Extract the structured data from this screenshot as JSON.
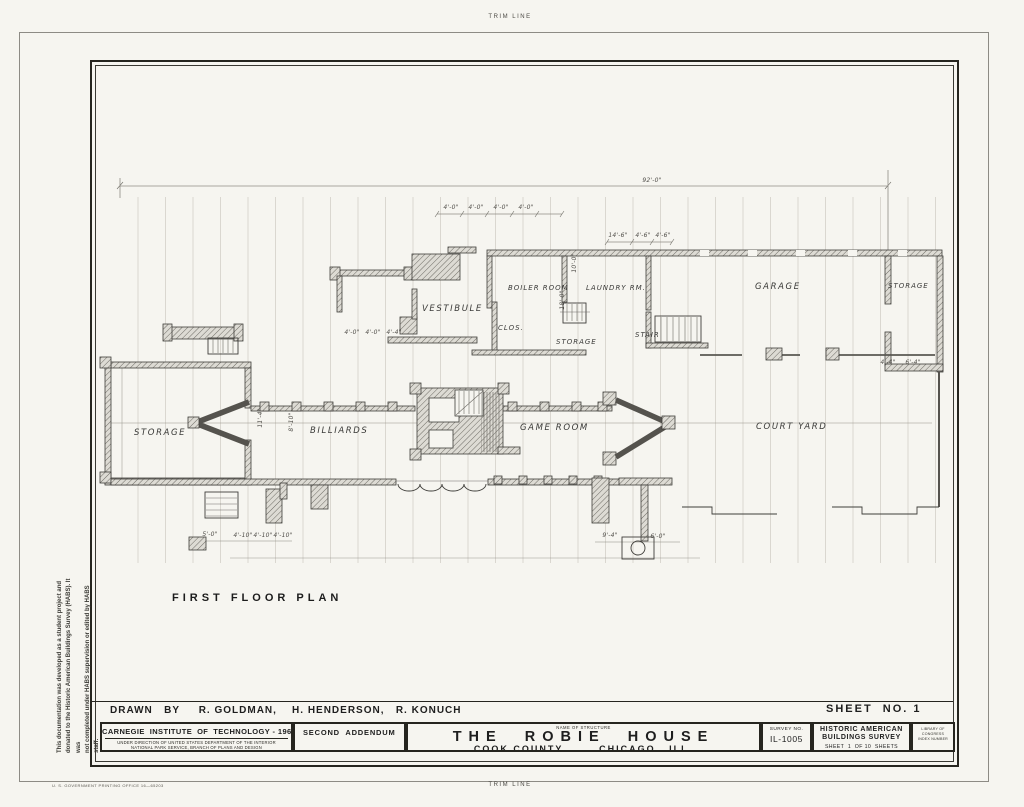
{
  "colors": {
    "paper": "#f6f5f0",
    "ink": "#26251f",
    "wall": "#55534e",
    "grid": "#c6c3ba"
  },
  "sheet": {
    "trim_line_top": "TRIM LINE",
    "trim_line_bottom": "TRIM LINE",
    "gpo_imprint": "U. S. GOVERNMENT PRINTING OFFICE      16—65203",
    "disclaimer_line1": "This documentation was developed as a student project and",
    "disclaimer_line2": "donated to the Historic American Buildings Survey (HABS). It was",
    "disclaimer_line3": "not completed under HABS supervision or edited by HABS staff."
  },
  "plan": {
    "title": "FIRST  FLOOR  PLAN",
    "rooms": [
      {
        "id": "storage-west",
        "label": "STORAGE"
      },
      {
        "id": "billiards",
        "label": "BILLIARDS"
      },
      {
        "id": "game-room",
        "label": "GAME ROOM"
      },
      {
        "id": "court-yard",
        "label": "COURT  YARD"
      },
      {
        "id": "vestibule",
        "label": "VESTIBULE"
      },
      {
        "id": "boiler-room",
        "label": "BOILER ROOM"
      },
      {
        "id": "laundry-rm",
        "label": "LAUNDRY RM."
      },
      {
        "id": "storage-mid",
        "label": "STORAGE"
      },
      {
        "id": "stair",
        "label": "STAIR"
      },
      {
        "id": "garage",
        "label": "GARAGE"
      },
      {
        "id": "storage-ne",
        "label": "STORAGE"
      },
      {
        "id": "closet",
        "label": "CLOS."
      }
    ],
    "dimensions": [
      "92'-0\"",
      "4'-0\"",
      "4'-0\"",
      "4'-0\"",
      "4'-0\"",
      "14'-6\"",
      "4'-6\"",
      "4'-6\"",
      "18'-0\"",
      "10'-0\"",
      "11'-4\"",
      "8'-10\"",
      "5'-0\"",
      "4'-10\"",
      "4'-10\"",
      "4'-10\"",
      "9'-4\"",
      "6'-0\"",
      "4'-0\"",
      "4'-0\"",
      "4'-4\"",
      "4'-4\"",
      "6'-4\""
    ]
  },
  "title_block": {
    "drawn_by": "DRAWN   BY     R. GOLDMAN,    H. HENDERSON,   R. KONUCH",
    "sheet_no": "SHEET  NO. 1",
    "institution": "CARNEGIE  INSTITUTE  OF  TECHNOLOGY - 1962",
    "institution_sub1": "UNDER DIRECTION OF UNITED STATES DEPARTMENT OF THE INTERIOR",
    "institution_sub2": "NATIONAL PARK SERVICE, BRANCH OF PLANS AND DESIGN",
    "addendum": "SECOND  ADDENDUM",
    "name_of_structure_label": "NAME OF STRUCTURE",
    "structure_name": "THE  ROBIE  HOUSE",
    "structure_location": "COOK COUNTY        CHICAGO , ILL.",
    "survey_no_label": "SURVEY NO.",
    "survey_no": "IL-1005",
    "habs_line1": "HISTORIC AMERICAN",
    "habs_line2": "BUILDINGS SURVEY",
    "sheet_of": "SHEET  1  OF 10  SHEETS",
    "loc_line1": "LIBRARY OF CONGRESS",
    "loc_line2": "INDEX NUMBER"
  }
}
